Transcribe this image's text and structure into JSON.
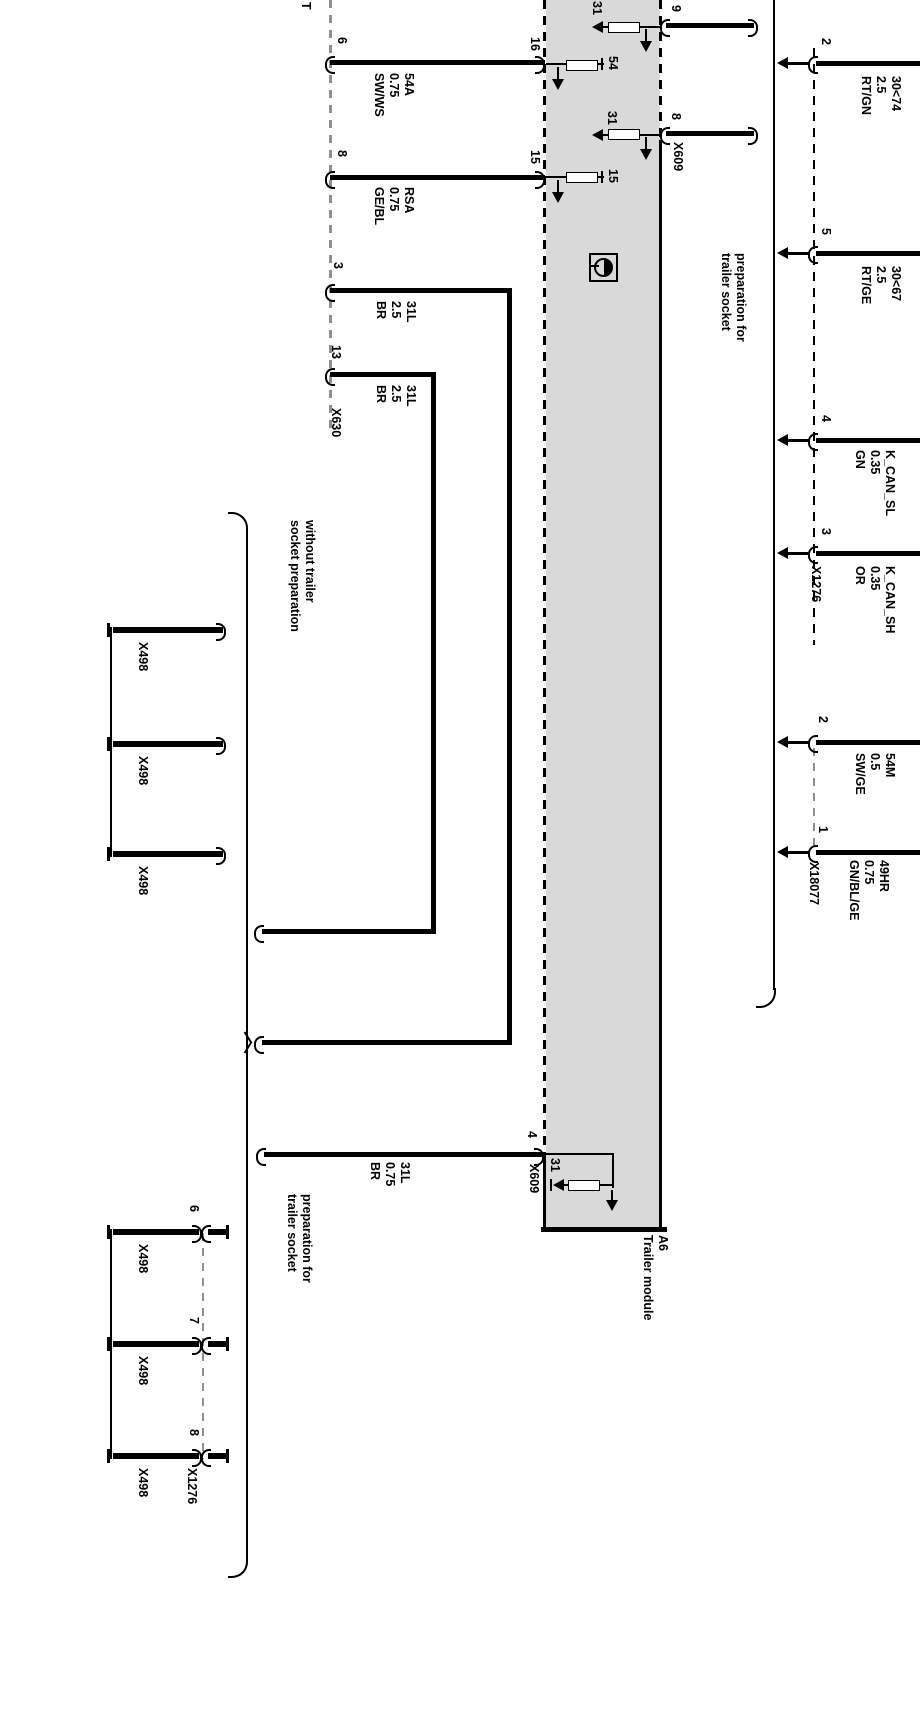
{
  "left_harness": {
    "partial_label": "T",
    "pins": [
      {
        "pin": "6",
        "module_pin": "16",
        "wire": "54A\n0.75\nSW/WS"
      },
      {
        "pin": "8",
        "module_pin": "15",
        "wire": "RSA\n0.75\nGE/BL"
      },
      {
        "pin": "3",
        "wire": "31L\n2.5\nBR"
      },
      {
        "pin": "13",
        "connector": "X630",
        "wire": "31L\n2.5\nBR"
      }
    ]
  },
  "module": {
    "id": "A6",
    "label": "A6\nTrailer module",
    "fuses": [
      {
        "terminal": "31"
      },
      {
        "terminal": "54"
      },
      {
        "terminal": "31"
      },
      {
        "terminal": "15"
      },
      {
        "terminal": "31"
      }
    ],
    "right_pins": [
      {
        "pin": "9"
      },
      {
        "pin": "8"
      }
    ],
    "connector_x609_top": "X609",
    "pin4": {
      "pin": "4",
      "connector": "X609",
      "wire": "31L\n0.75\nBR"
    }
  },
  "right_harness": {
    "note": "preparation for\ntrailer socket",
    "x1276": {
      "connector": "X1276",
      "pins": [
        {
          "pin": "2",
          "wire": "30<74\n2.5\nRT/GN"
        },
        {
          "pin": "5",
          "wire": "30<67\n2.5\nRT/GE"
        },
        {
          "pin": "4",
          "wire": "K_CAN_SL\n0.35\nGN"
        },
        {
          "pin": "3",
          "wire": "K_CAN_SH\n0.35\nOR"
        }
      ]
    },
    "x18077": {
      "connector": "X18077",
      "pins": [
        {
          "pin": "2",
          "wire": "54M\n0.5\nSW/GE"
        },
        {
          "pin": "1",
          "wire": "49HR\n0.75\nGN/BL/GE"
        }
      ]
    }
  },
  "options": {
    "without_note": "without trailer\nsocket preparation",
    "with_note": "preparation for\ntrailer socket",
    "x498_unmated": [
      {
        "label": "X498"
      },
      {
        "label": "X498"
      },
      {
        "label": "X498"
      }
    ],
    "x498_mated": [
      {
        "pin": "6",
        "label": "X498"
      },
      {
        "pin": "7",
        "label": "X498"
      },
      {
        "pin": "8",
        "label": "X498"
      }
    ],
    "mate_connector": "X1276"
  },
  "colors": {
    "module_fill": "#d9d9d9",
    "wire": "#000000",
    "dash_gray": "#8f8f8f",
    "background": "#ffffff"
  }
}
